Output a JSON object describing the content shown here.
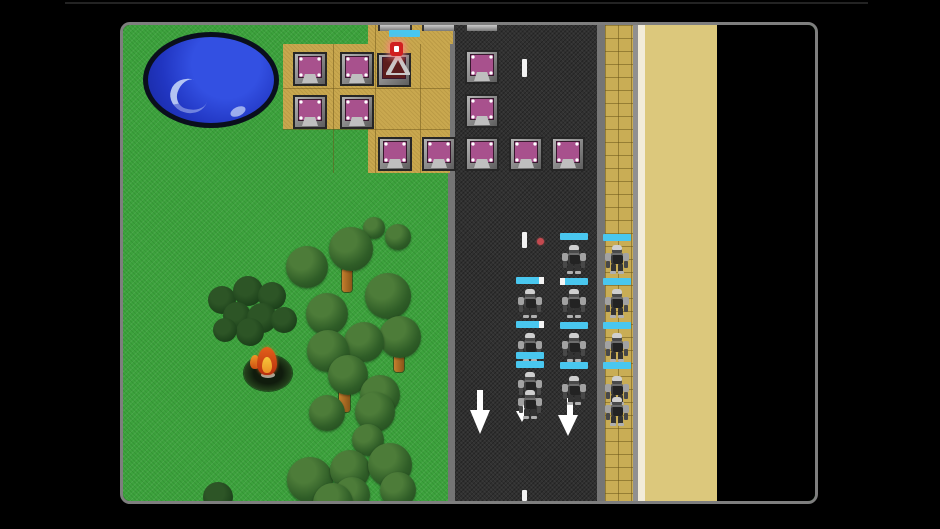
{
  "scene": "tower-defense-game-screenshot",
  "colors": {
    "background": "#000000",
    "grass": "#3da23d",
    "road": "#303030",
    "curb": "#757575",
    "plot_tan": "#c9a84f",
    "sidewalk_tan": "#c9ad55",
    "gray_strip": "#909090",
    "white_strip": "#f2ecd9",
    "sand": "#dcc87c",
    "void": "#000000",
    "pond_blue": "#2136c2",
    "health_bar_cyan": "#49c7ef",
    "tower_core_purple": "#a8518d",
    "damaged_core_red": "#5c1d1d",
    "damage_icon_red": "#d02020",
    "projectile_red": "#c4494f",
    "tree_green": "#2f5d27",
    "bush_green": "#1d421b",
    "trunk_brown": "#b5712c",
    "fire_orange": "#e2601a",
    "fire_yellow": "#f6c63a",
    "viewport_border": "#7e7e7e"
  },
  "viewport": {
    "x": 120,
    "y": 22,
    "w": 692,
    "h": 476
  },
  "terrain_strips": [
    {
      "name": "grass-field",
      "cls": "grass",
      "x": 0,
      "w": 692
    },
    {
      "name": "road-curb-left",
      "cls": "",
      "x": 325,
      "w": 7,
      "color": "#757575"
    },
    {
      "name": "road",
      "cls": "road",
      "x": 332,
      "w": 142
    },
    {
      "name": "road-curb-right",
      "cls": "",
      "x": 474,
      "w": 8,
      "color": "#757575"
    },
    {
      "name": "sidewalk",
      "cls": "sidewalk",
      "x": 482,
      "w": 28
    },
    {
      "name": "gray-strip",
      "cls": "",
      "x": 510,
      "w": 5,
      "color": "#909090"
    },
    {
      "name": "white-strip",
      "cls": "",
      "x": 515,
      "w": 7,
      "color": "#f2ecd9"
    },
    {
      "name": "sand-field",
      "cls": "",
      "x": 522,
      "w": 72,
      "color": "#dcc87c"
    },
    {
      "name": "void-area",
      "cls": "",
      "x": 594,
      "w": 98,
      "color": "#000000"
    }
  ],
  "pond": {
    "x": 20,
    "y": 7,
    "w": 136,
    "h": 96,
    "hl1": {
      "x": 22,
      "y": 42,
      "w": 38,
      "h": 34
    },
    "hl2": {
      "x": 82,
      "y": 70,
      "w": 16,
      "h": 9
    }
  },
  "build_plots": [
    {
      "x": 160,
      "y": 19,
      "w": 167,
      "h": 85
    },
    {
      "x": 245,
      "y": 104,
      "w": 82,
      "h": 44
    },
    {
      "x": 245,
      "y": 0,
      "w": 85,
      "h": 19
    }
  ],
  "plot_grid_lines": [
    {
      "x": 210,
      "y": 19,
      "w": 1,
      "h": 129
    },
    {
      "x": 252,
      "y": 0,
      "w": 1,
      "h": 148
    },
    {
      "x": 297,
      "y": 19,
      "w": 1,
      "h": 129
    },
    {
      "x": 160,
      "y": 63,
      "w": 167,
      "h": 1
    },
    {
      "x": 160,
      "y": 104,
      "w": 167,
      "h": 1
    }
  ],
  "towers": [
    {
      "x": 170,
      "y": 27,
      "type": "normal"
    },
    {
      "x": 217,
      "y": 27,
      "type": "normal"
    },
    {
      "x": 254,
      "y": 28,
      "type": "damaged"
    },
    {
      "x": 170,
      "y": 70,
      "type": "normal"
    },
    {
      "x": 217,
      "y": 70,
      "type": "normal"
    },
    {
      "x": 255,
      "y": 112,
      "type": "normal"
    },
    {
      "x": 299,
      "y": 112,
      "type": "normal"
    },
    {
      "x": 342,
      "y": 25,
      "type": "normal"
    },
    {
      "x": 342,
      "y": 69,
      "type": "normal"
    },
    {
      "x": 342,
      "y": 112,
      "type": "normal"
    },
    {
      "x": 386,
      "y": 112,
      "type": "normal"
    },
    {
      "x": 428,
      "y": 112,
      "type": "normal"
    }
  ],
  "tower_stubs": [
    {
      "x": 255,
      "y": 0
    },
    {
      "x": 299,
      "y": 0
    },
    {
      "x": 342,
      "y": 0
    }
  ],
  "top_health_bar": {
    "x": 266,
    "y": 5,
    "w": 31,
    "h": 7
  },
  "damage_indicator": {
    "x": 267,
    "y": 17
  },
  "lane_dashes": [
    {
      "x": 399,
      "y": 34,
      "w": 5,
      "h": 18
    },
    {
      "x": 399,
      "y": 207,
      "w": 5,
      "h": 16
    },
    {
      "x": 399,
      "y": 465,
      "w": 5,
      "h": 11
    }
  ],
  "projectile": {
    "x": 414,
    "y": 213,
    "w": 7,
    "h": 7
  },
  "path_arrows": [
    {
      "stem": {
        "x": 354,
        "y": 365,
        "w": 6,
        "h": 22
      },
      "head": {
        "x": 347,
        "y": 385,
        "w": 20,
        "h": 24
      }
    },
    {
      "stem": {
        "x": 444,
        "y": 373,
        "w": 6,
        "h": 19
      },
      "head": {
        "x": 435,
        "y": 390,
        "w": 20,
        "h": 21
      }
    },
    {
      "stem": {
        "x": 398,
        "y": 377,
        "w": 4,
        "h": 11
      },
      "head": {
        "x": 393,
        "y": 386,
        "w": 13,
        "h": 11
      }
    }
  ],
  "robots": [
    {
      "x": 394,
      "y": 264
    },
    {
      "x": 394,
      "y": 308
    },
    {
      "x": 394,
      "y": 347
    },
    {
      "x": 394,
      "y": 365
    },
    {
      "x": 438,
      "y": 220
    },
    {
      "x": 438,
      "y": 264
    },
    {
      "x": 438,
      "y": 308
    },
    {
      "x": 438,
      "y": 351
    },
    {
      "x": 481,
      "y": 220
    },
    {
      "x": 481,
      "y": 264
    },
    {
      "x": 481,
      "y": 308
    },
    {
      "x": 481,
      "y": 351
    },
    {
      "x": 481,
      "y": 372
    }
  ],
  "health_bars": [
    {
      "x": 393,
      "y": 252,
      "tip": "right"
    },
    {
      "x": 393,
      "y": 296,
      "tip": "right"
    },
    {
      "x": 393,
      "y": 327,
      "tip": "none"
    },
    {
      "x": 393,
      "y": 336,
      "tip": "none"
    },
    {
      "x": 437,
      "y": 208,
      "tip": "none"
    },
    {
      "x": 437,
      "y": 253,
      "tip": "left"
    },
    {
      "x": 437,
      "y": 297,
      "tip": "none"
    },
    {
      "x": 437,
      "y": 337,
      "tip": "none"
    },
    {
      "x": 480,
      "y": 209,
      "tip": "none"
    },
    {
      "x": 480,
      "y": 253,
      "tip": "none"
    },
    {
      "x": 480,
      "y": 297,
      "tip": "none"
    },
    {
      "x": 480,
      "y": 337,
      "tip": "none"
    }
  ],
  "tree_trunks": [
    {
      "x": 219,
      "y": 243,
      "w": 10,
      "h": 24
    },
    {
      "x": 259,
      "y": 268,
      "w": 10,
      "h": 24
    },
    {
      "x": 271,
      "y": 327,
      "w": 10,
      "h": 20
    },
    {
      "x": 216,
      "y": 365,
      "w": 11,
      "h": 22
    },
    {
      "x": 200,
      "y": 380,
      "w": 11,
      "h": 24
    },
    {
      "x": 223,
      "y": 457,
      "w": 10,
      "h": 20
    },
    {
      "x": 248,
      "y": 399,
      "w": 9,
      "h": 16
    }
  ],
  "tree_canopies": [
    {
      "cx": 251,
      "cy": 203,
      "r": 11
    },
    {
      "cx": 275,
      "cy": 212,
      "r": 13
    },
    {
      "cx": 228,
      "cy": 224,
      "r": 22
    },
    {
      "cx": 184,
      "cy": 242,
      "r": 21
    },
    {
      "cx": 265,
      "cy": 271,
      "r": 23
    },
    {
      "cx": 204,
      "cy": 289,
      "r": 21
    },
    {
      "cx": 277,
      "cy": 312,
      "r": 21
    },
    {
      "cx": 241,
      "cy": 317,
      "r": 20
    },
    {
      "cx": 205,
      "cy": 326,
      "r": 21
    },
    {
      "cx": 225,
      "cy": 350,
      "r": 20
    },
    {
      "cx": 257,
      "cy": 370,
      "r": 20
    },
    {
      "cx": 204,
      "cy": 388,
      "r": 18
    },
    {
      "cx": 252,
      "cy": 387,
      "r": 20
    },
    {
      "cx": 245,
      "cy": 415,
      "r": 16
    },
    {
      "cx": 187,
      "cy": 455,
      "r": 23
    },
    {
      "cx": 227,
      "cy": 445,
      "r": 20
    },
    {
      "cx": 267,
      "cy": 440,
      "r": 22
    },
    {
      "cx": 229,
      "cy": 470,
      "r": 18
    },
    {
      "cx": 275,
      "cy": 465,
      "r": 18
    },
    {
      "cx": 210,
      "cy": 478,
      "r": 20
    }
  ],
  "bushes": [
    {
      "cx": 99,
      "cy": 275,
      "r": 14
    },
    {
      "cx": 125,
      "cy": 266,
      "r": 15
    },
    {
      "cx": 149,
      "cy": 271,
      "r": 14
    },
    {
      "cx": 114,
      "cy": 291,
      "r": 14
    },
    {
      "cx": 139,
      "cy": 293,
      "r": 15
    },
    {
      "cx": 161,
      "cy": 295,
      "r": 13
    },
    {
      "cx": 127,
      "cy": 307,
      "r": 14
    },
    {
      "cx": 102,
      "cy": 305,
      "r": 12
    },
    {
      "cx": 95,
      "cy": 472,
      "r": 15
    }
  ],
  "campfire": {
    "pit": {
      "x": 121,
      "y": 330,
      "w": 48,
      "h": 36
    },
    "stone": {
      "x": 138,
      "y": 347,
      "w": 14,
      "h": 6
    },
    "flame_outer": {
      "x": 134,
      "y": 322,
      "w": 20,
      "h": 28
    },
    "flame_inner": {
      "x": 139,
      "y": 332,
      "w": 10,
      "h": 16
    },
    "flame_side": {
      "x": 127,
      "y": 330,
      "w": 10,
      "h": 14
    }
  }
}
